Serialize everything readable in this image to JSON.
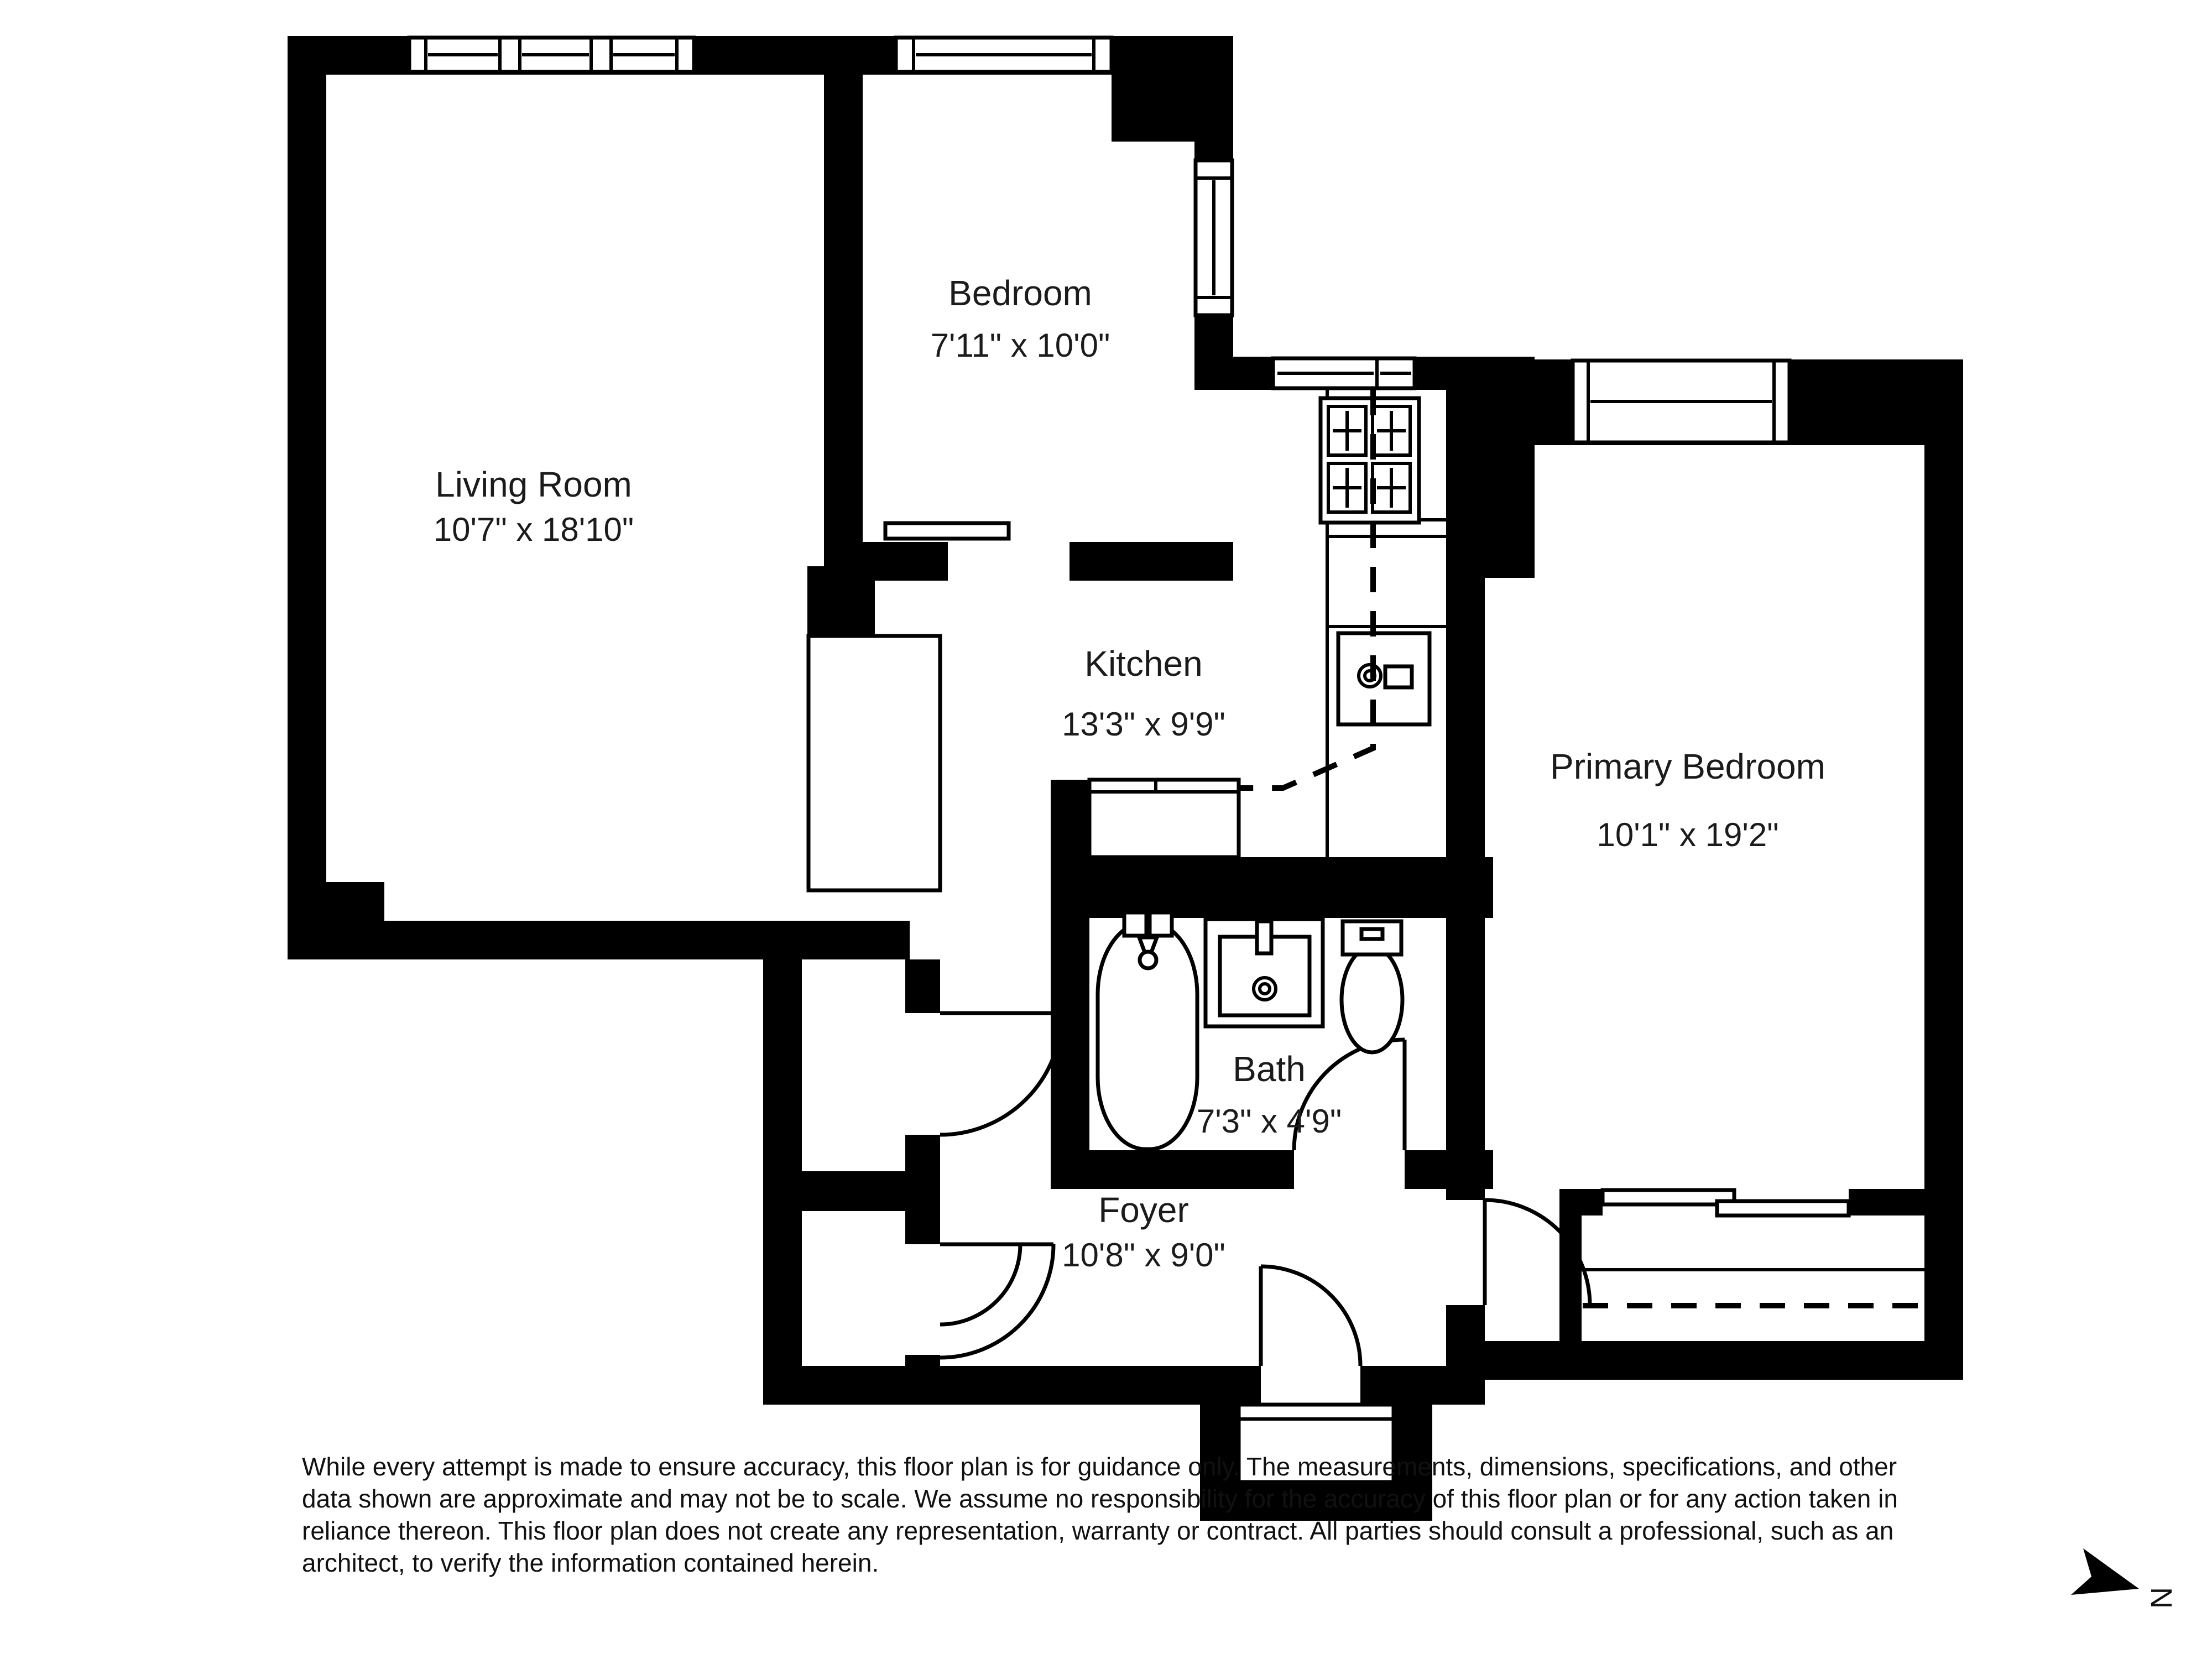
{
  "plan": {
    "rooms": {
      "living": {
        "name": "Living Room",
        "dims": "10'7\" x 18'10\""
      },
      "bedroom": {
        "name": "Bedroom",
        "dims": "7'11\" x 10'0\""
      },
      "kitchen": {
        "name": "Kitchen",
        "dims": "13'3\" x 9'9\""
      },
      "primary": {
        "name": "Primary Bedroom",
        "dims": "10'1\" x 19'2\""
      },
      "bath": {
        "name": "Bath",
        "dims": "7'3\" x 4'9\""
      },
      "foyer": {
        "name": "Foyer",
        "dims": "10'8\" x 9'0\""
      }
    },
    "compass": {
      "label": "N"
    },
    "disclaimer": {
      "line1": "While every attempt is made to ensure accuracy, this floor plan is for guidance only. The measurements, dimensions, specifications, and other",
      "line2": "data shown are approximate and may not be to scale. We assume no responsibility for the accuracy of this floor plan or for any action taken in",
      "line3": "reliance thereon. This floor plan does not create any representation, warranty or contract. All parties should consult a professional, such as an",
      "line4": "architect, to verify the information contained herein."
    },
    "colors": {
      "wall": "#000000",
      "background": "#ffffff",
      "text": "#1b1b1b"
    }
  }
}
